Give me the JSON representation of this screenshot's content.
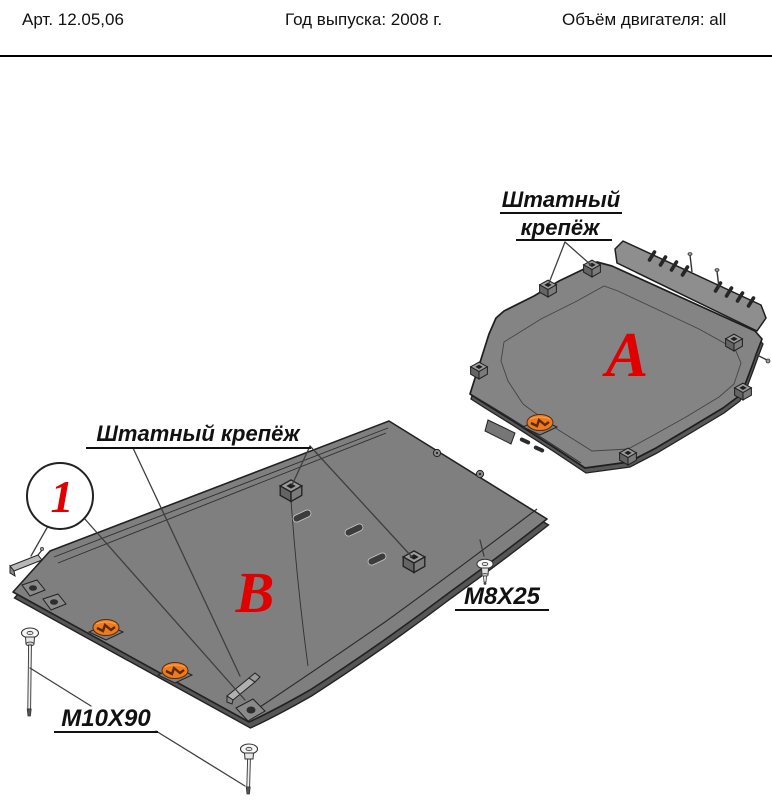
{
  "header": {
    "article": "Арт. 12.05,06",
    "year": "Год выпуска: 2008 г.",
    "engine": "Объём двигателя: all"
  },
  "diagram": {
    "part_a": {
      "letter": "A"
    },
    "part_b": {
      "letter": "B"
    },
    "callout_1": {
      "number": "1"
    },
    "fastener_label_a": {
      "line1": "Штатный",
      "line2": "крепёж"
    },
    "fastener_label_b": "Штатный крепёж",
    "bolt_label_m8": "M8X25",
    "bolt_label_m10": "M10X90",
    "colors": {
      "letter_red": "#e00000",
      "logo_orange": "#ee7b1c",
      "plate_gray": "#828282",
      "plate_side_gray": "#565656",
      "outline": "#222222"
    }
  }
}
